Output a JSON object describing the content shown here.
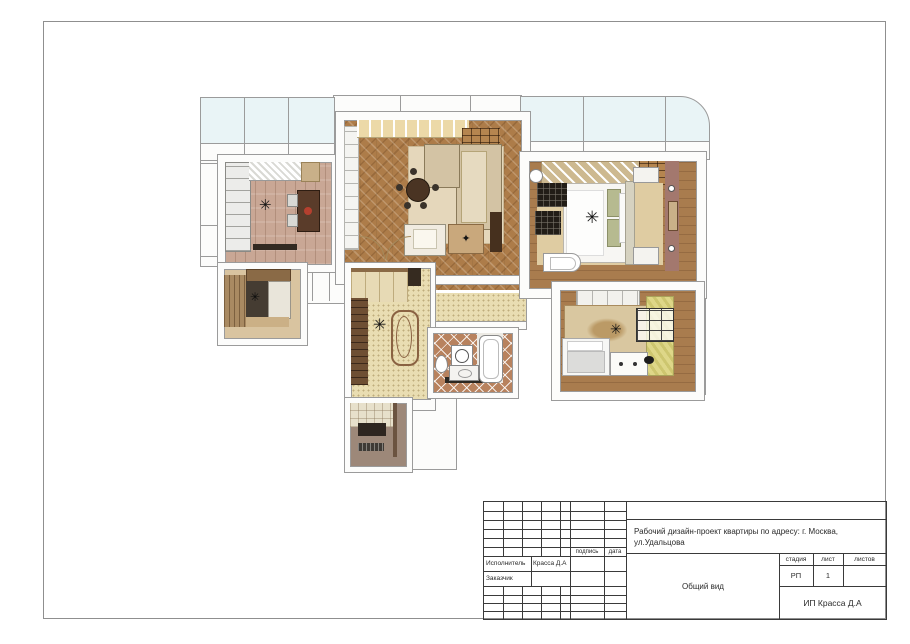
{
  "titleblock": {
    "project_title": "Рабочий дизайн-проект квартиры по адресу: г. Москва, ул.Удальцова",
    "view_label": "Общий вид",
    "executor_label": "Исполнитель",
    "executor_name": "Красса Д.А",
    "client_label": "Заказчик",
    "signature_label": "подпись",
    "date_label": "дата",
    "stage_label": "стадия",
    "sheet_label": "лист",
    "sheets_label": "листов",
    "stage_value": "РП",
    "sheet_value": "1",
    "sheets_value": "",
    "company": "ИП Красса Д.А"
  },
  "icons": {
    "chandelier": "✳",
    "plant": "✦"
  },
  "colors": {
    "wall_line": "#9b9b9b",
    "balcony_glass": "#e9f4f6",
    "kitchen_floor": "#c9a795",
    "living_floor": "#ad7c49",
    "hall_floor": "#e9ddb2",
    "wood_floor": "#a97c4e",
    "bath_floor": "#b8825e",
    "entry_floor": "#9d8879",
    "curtain_olive": "#cdc66f",
    "bedroom_rug": "#dfcca2",
    "kids_rug": "#d9c7a0",
    "accent_wall": "#a3786e",
    "sofa_beige": "#d3c3a4",
    "dark_furniture": "#2e2620"
  }
}
